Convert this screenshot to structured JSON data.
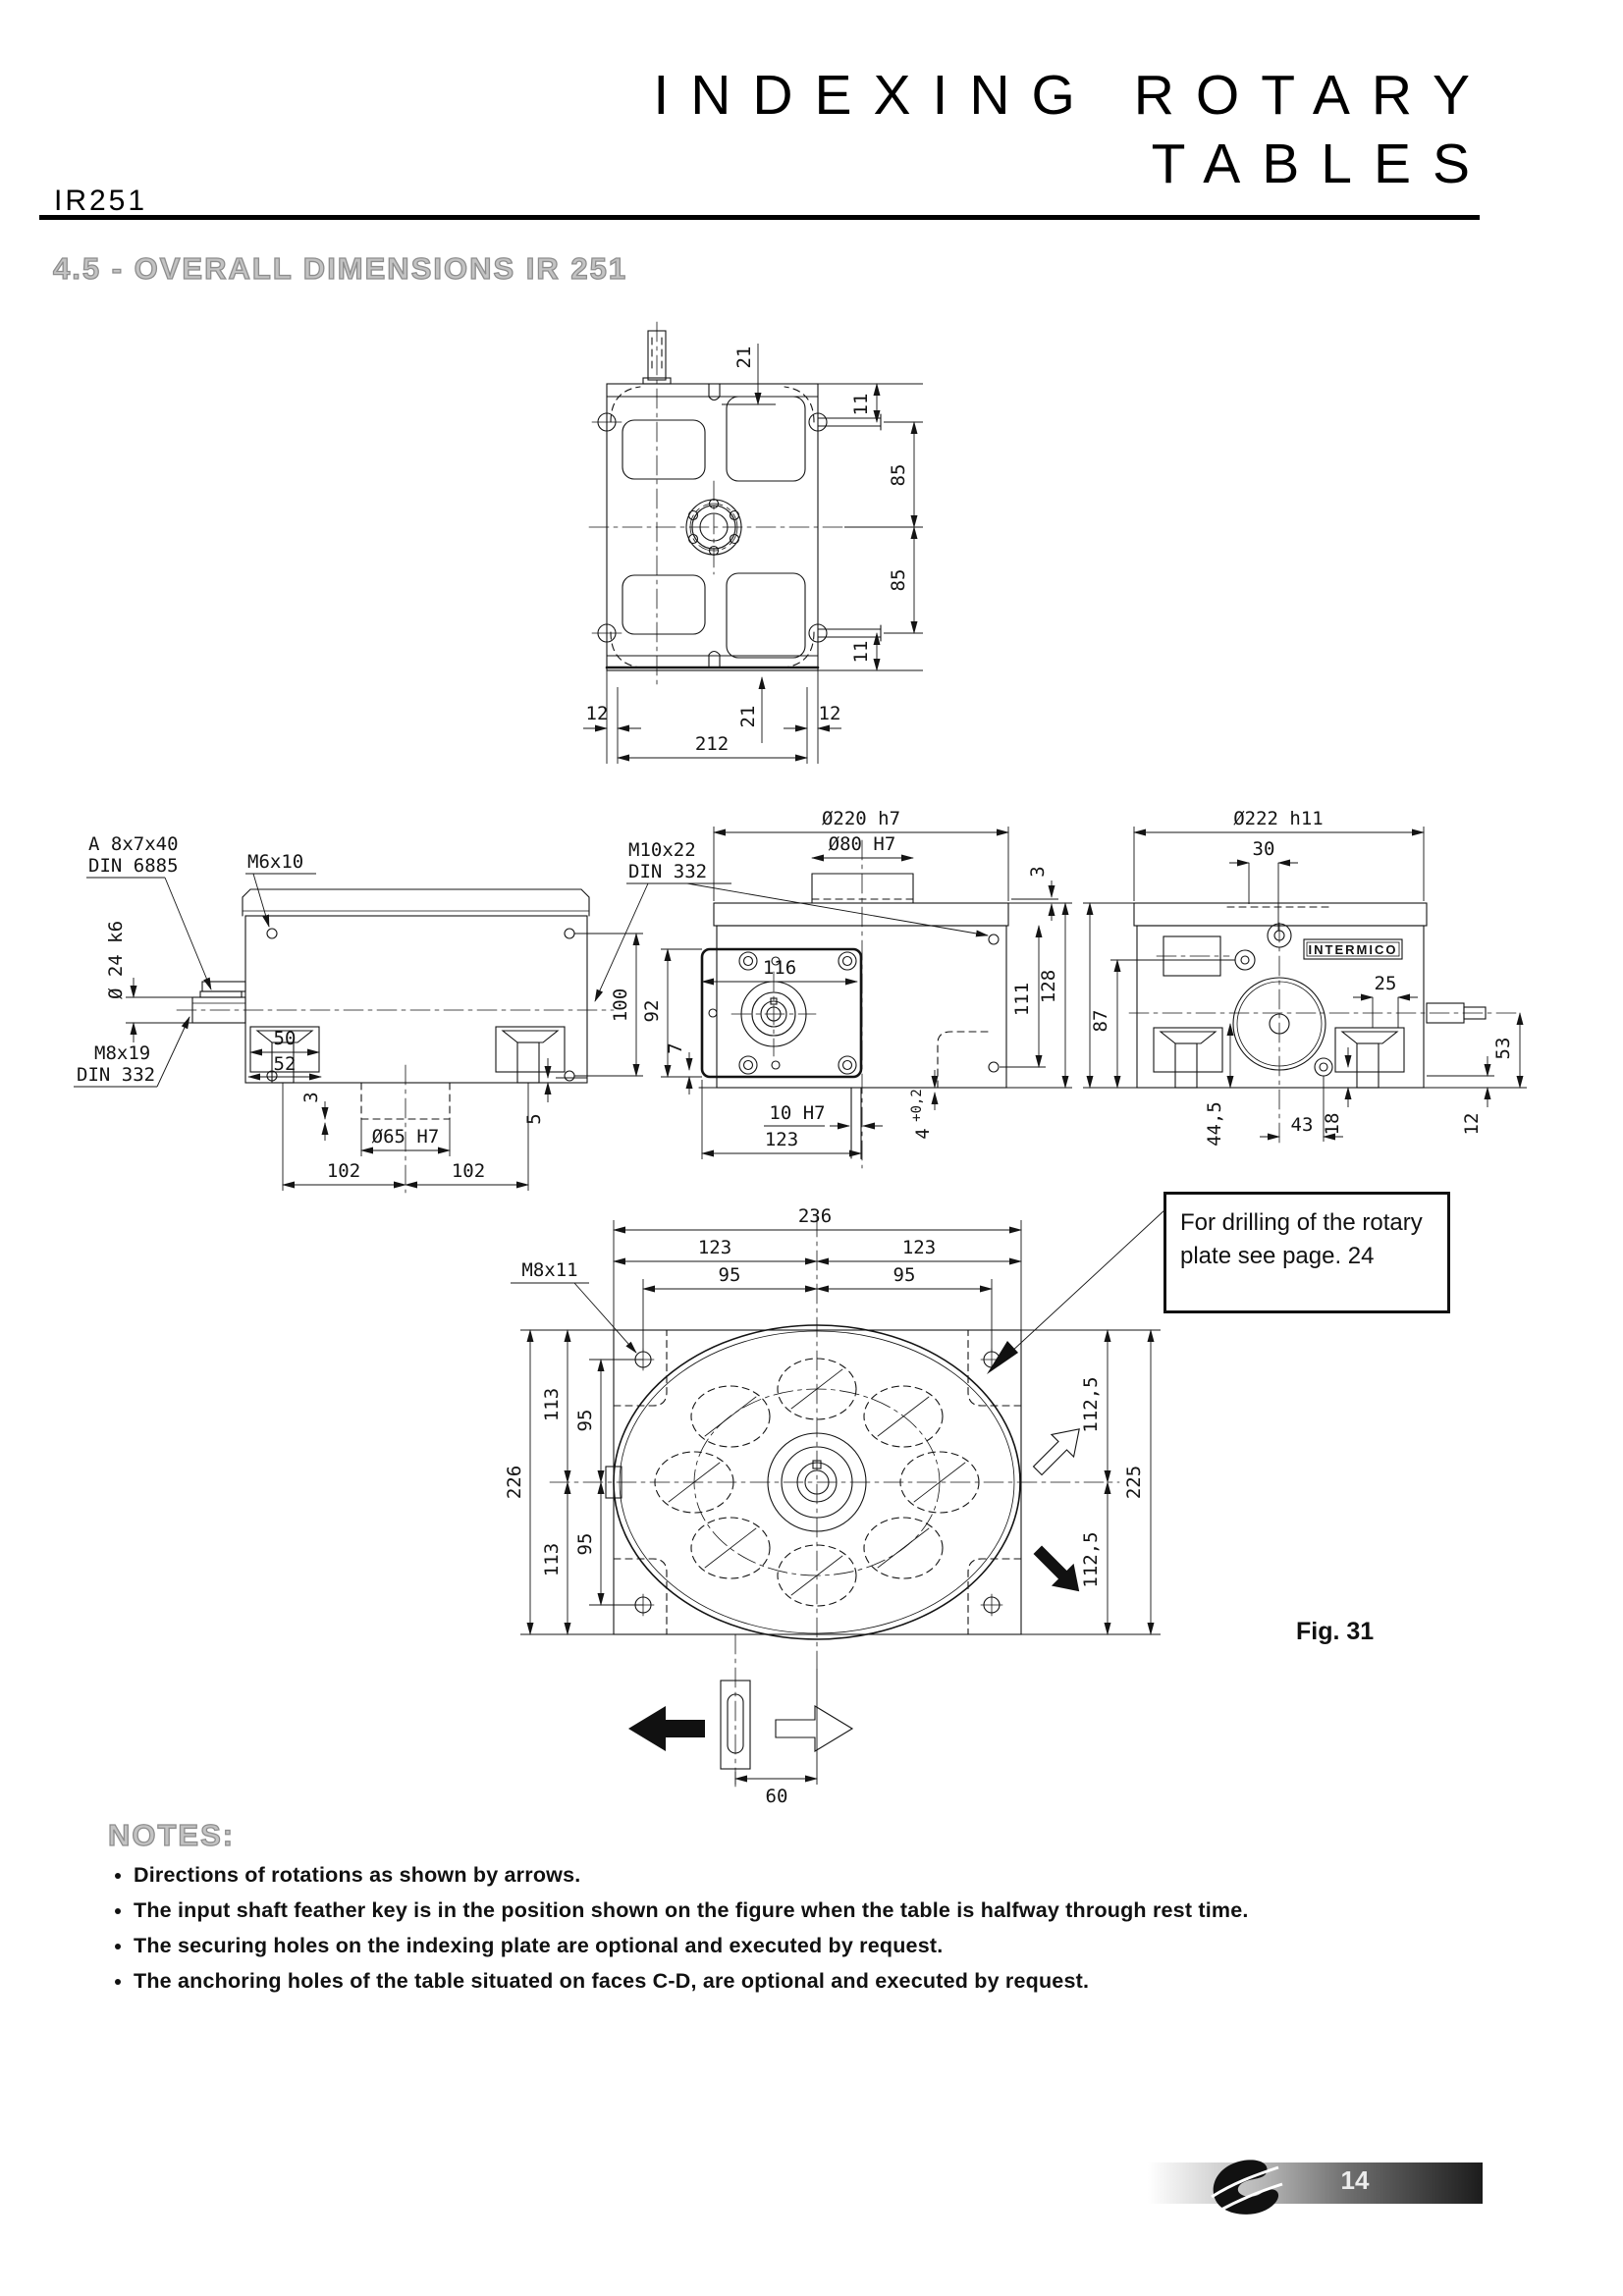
{
  "header": {
    "model": "IR251",
    "title_line1": "INDEXING ROTARY",
    "title_line2": "TABLES"
  },
  "section_title": "4.5 - OVERALL DIMENSIONS IR 251",
  "drawing": {
    "top": {
      "d21_top": "21",
      "d11_top": "11",
      "d85_top": "85",
      "d85_bottom": "85",
      "d11_bottom": "11",
      "d12_left": "12",
      "d21_bottom": "21",
      "d212": "212",
      "d12_right": "12"
    },
    "front": {
      "key_label_1": "A 8x7x40",
      "key_label_2": "DIN 6885",
      "m6": "M6x10",
      "shaft_dia": "Ø 24 k6",
      "m8_1": "M8x19",
      "m8_2": "DIN 332",
      "d50": "50",
      "d52": "52",
      "d3": "3",
      "d65": "Ø65 H7",
      "d102_left": "102",
      "d102_right": "102",
      "d100": "100",
      "d5": "5"
    },
    "side": {
      "m10_1": "M10x22",
      "m10_2": "DIN 332",
      "d220": "Ø220 h7",
      "d80": "Ø80 H7",
      "d116": "116",
      "d92": "92",
      "d7": "7",
      "d111": "111",
      "d128": "128",
      "d3": "3",
      "d10": "10 H7",
      "d123": "123",
      "d4": "4",
      "d4_tol": "+0,2"
    },
    "rear": {
      "d222": "Ø222 h11",
      "d30": "30",
      "d87": "87",
      "d25": "25",
      "d53": "53",
      "d44": "44,5",
      "d43": "43",
      "d18": "18",
      "d12": "12",
      "brand": "INTERMICO"
    },
    "plate": {
      "d236": "236",
      "d123_left": "123",
      "d123_right": "123",
      "d95_top_left": "95",
      "d95_top_right": "95",
      "m8": "M8x11",
      "d113_top": "113",
      "d95_left_top": "95",
      "d226": "226",
      "d95_left_bottom": "95",
      "d113_bottom": "113",
      "d112_top": "112,5",
      "d225": "225",
      "d112_bottom": "112,5",
      "d60": "60"
    }
  },
  "callout": {
    "line1": "For drilling of the rotary",
    "line2": "plate see page. 24"
  },
  "figure_label": "Fig. 31",
  "notes": {
    "heading": "NOTES:",
    "items": [
      "Directions of rotations as shown by arrows.",
      "The input shaft feather key is in the position shown on the figure when the table is halfway through rest time.",
      "The securing holes on the indexing plate are optional and executed by request.",
      "The anchoring holes of the table situated on faces C-D, are optional and executed by request."
    ]
  },
  "footer": {
    "page_number": "14"
  }
}
